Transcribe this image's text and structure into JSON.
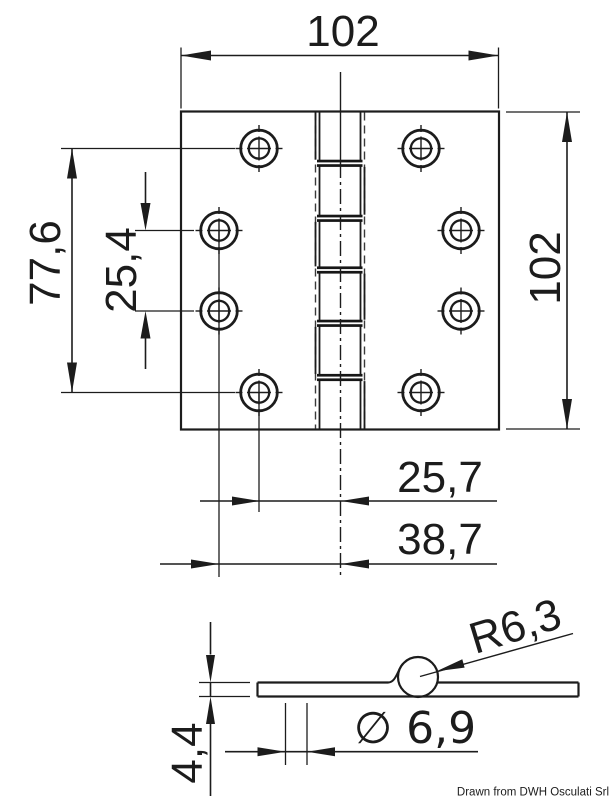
{
  "document": {
    "type": "technical-drawing",
    "subject": "square marine hinge, plan and section views",
    "credit": "Drawn from DWH Osculati Srl"
  },
  "colors": {
    "line": "#1c1c1c",
    "background": "#ffffff"
  },
  "top_view": {
    "dim_overall_width": "102",
    "dim_overall_height": "102",
    "dim_hole_row_span": "77,6",
    "dim_hole_row_pitch": "25,4",
    "dim_hole_col_inner_offset": "25,7",
    "dim_hole_col_outer_offset": "38,7"
  },
  "side_view": {
    "dim_knuckle_radius": "R6,3",
    "dim_leaf_thickness": "4,4",
    "dim_pin_diameter": "∅ 6,9"
  }
}
